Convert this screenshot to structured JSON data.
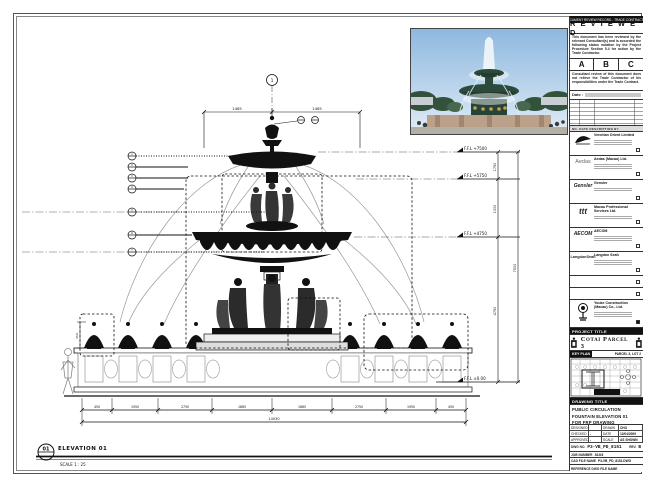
{
  "sheet": {
    "bg": "#ffffff",
    "line": "#1a1a1a"
  },
  "stamp": {
    "header": "DOCUMENT REVIEW RECORD - TRADE CONTRACTOR",
    "title": "R E V I E W E D",
    "para1": "This document has been reviewed by the relevant Consultant(s) and is accorded the following status notation  by the Project Procedure Section 5.4 for action by the Trade Contractor.",
    "options": {
      "a": "A",
      "b": "B",
      "c": "C"
    },
    "para2": "Consultant review of this document does not relieve the Trade Contractor of his responsibilities under the Trade Contract.",
    "date_label": "Date :",
    "rev_header": "NO.   DATE   DESCRIPTION   BY"
  },
  "consultants": [
    {
      "name": "Venetian Orient Limited"
    },
    {
      "logo_text": "Aedas",
      "name": "Aedas (Macau) Ltd."
    },
    {
      "logo_text": "Gensler",
      "name": "Gensler"
    },
    {
      "logo_text": "ttt",
      "name": "Macau Professional Services Ltd."
    },
    {
      "logo_text": "AECOM",
      "name": "AECOM"
    },
    {
      "logo_text": "LangdonSeah",
      "name": "Langdon Seah"
    },
    {
      "name": ""
    },
    {
      "name": ""
    },
    {
      "name": "Youke Construction (Macau) Co., Ltd."
    }
  ],
  "project": {
    "band": "PROJECT TITLE",
    "name": "Cotai Parcel 3"
  },
  "key_plan": {
    "band": "KEY PLAN",
    "right_label": "PARCEL 3, LOT 2",
    "tag": "PARCEL 3 LOT 2"
  },
  "drawing_title": {
    "band": "DRAWING TITLE",
    "lines": [
      "PUBLIC CIRCULATION",
      "FOUNTAIN ELEVATION 01",
      "FOR FRP DRAWING"
    ]
  },
  "signoff": {
    "rows": [
      [
        "DESIGNED",
        "",
        "DRAWN",
        "CHO"
      ],
      [
        "CHECKED",
        "-",
        "DATE",
        "12/04/2009"
      ],
      [
        "APPROVED",
        "-",
        "SCALE",
        "AS SHOWN"
      ]
    ]
  },
  "dwg": {
    "no_label": "DWG NO.",
    "no": "P3-VB_PD_8151",
    "rev_label": "REV.",
    "rev": "B",
    "job_label": "JOB NUMBER",
    "job": "3103",
    "cad_label": "CAD FILE NAME",
    "cad": "P3-VB_PD_8151.DWG",
    "ref_label": "REFERENCE DWG FILE NAME",
    "ref": ""
  },
  "elevation": {
    "tag": "01",
    "title": "ELEVATION 01",
    "scale": "SCALE  1 : 25"
  },
  "grid_bubble": "1",
  "levels": {
    "l1": "F.F.L +7500",
    "l2": "F.F.L +5750",
    "l3": "F.F.L +4750",
    "l4": "F.F.L ±0.00"
  },
  "dims": {
    "top_left": "1465",
    "top_right": "1465",
    "v1": "1750",
    "v2": "1000",
    "v3": "4750",
    "v_total": "7500",
    "lamp_h": "450",
    "b1": "450",
    "b2": "1950",
    "b3": "2750",
    "b4": "1865",
    "b5": "1865",
    "b6": "2750",
    "b7": "1950",
    "b8": "450",
    "b_total": "14030"
  },
  "callouts": {
    "c1": "1",
    "c2": "2",
    "c3": "3",
    "c4": "4",
    "c5": "5",
    "c6": "6",
    "c7": "7"
  },
  "photo_colors": {
    "sky": "#a9c8e4",
    "fountain_green": "#2c4a3c",
    "gold": "#c3a04a",
    "stone": "#bba08a"
  }
}
